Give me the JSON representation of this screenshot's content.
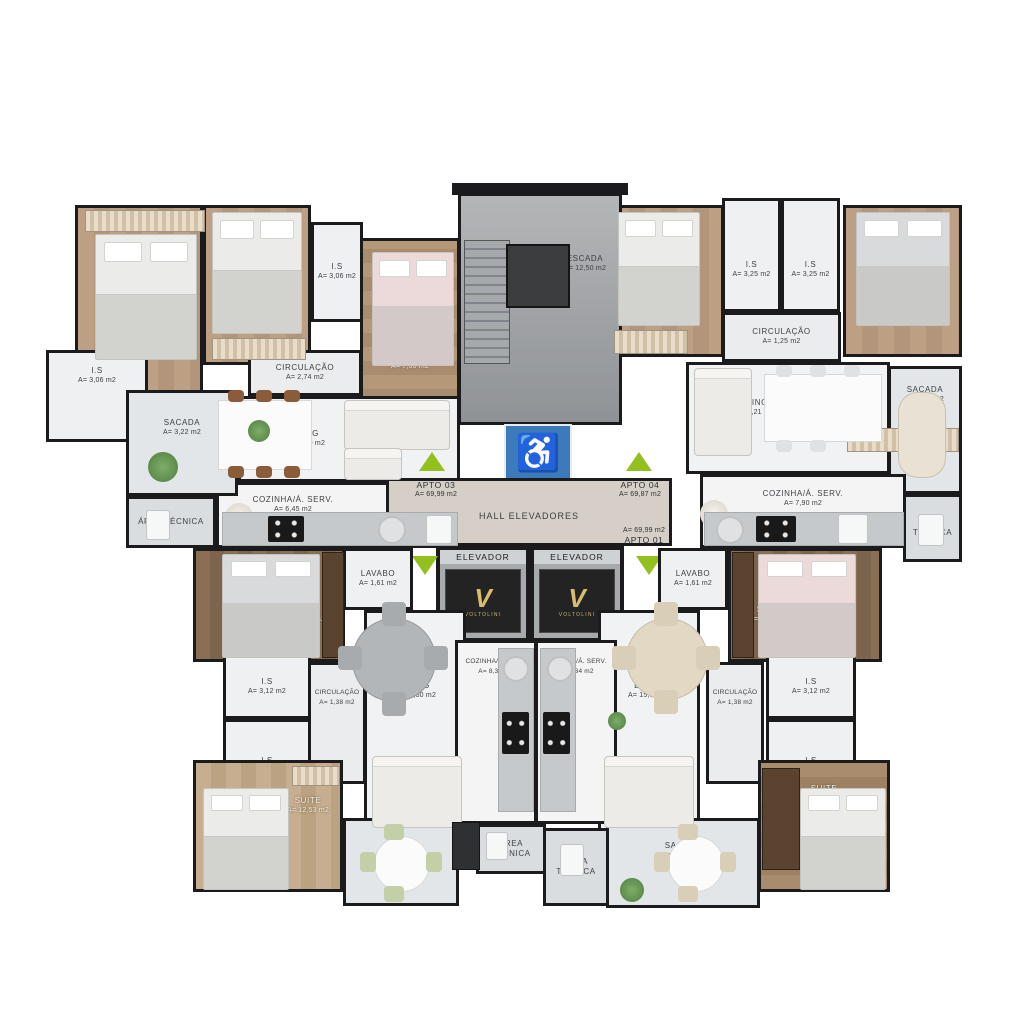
{
  "apartments": {
    "apto03": {
      "label": "APTO 03",
      "area": "A= 69,99 m2"
    },
    "apto04": {
      "label": "APTO 04",
      "area": "A= 69,87 m2"
    },
    "apto02": {
      "label": "APTO 02",
      "area": "A= 69,98 m2"
    },
    "apto01": {
      "label": "APTO 01",
      "area": "A= 69,99 m2"
    }
  },
  "core": {
    "escada": {
      "label": "ESCADA",
      "area": "A= 12,50 m2"
    },
    "hall": {
      "label": "HALL ELEVADORES"
    },
    "elevador1": {
      "label": "ELEVADOR",
      "brand": "VOLTOLINI"
    },
    "elevador2": {
      "label": "ELEVADOR",
      "brand": "VOLTOLINI"
    },
    "accessibility_symbol": "♿"
  },
  "rooms": {
    "a3_suite": {
      "label": "SUITE",
      "area": "A= 10,71 m2"
    },
    "a3_dorm1": {
      "label": "DORMITORIO",
      "area": "A= 7,60 m2"
    },
    "a3_dorm2": {
      "label": "DORMITORIO",
      "area": "A= 7,60 m2"
    },
    "a3_is1": {
      "label": "I.S",
      "area": "A= 3,06 m2"
    },
    "a3_is2": {
      "label": "I.S",
      "area": "A= 3,06 m2"
    },
    "a3_circ": {
      "label": "CIRCULAÇÃO",
      "area": "A= 2,74 m2"
    },
    "a3_living": {
      "label": "LIVING",
      "area": "A= 16,00 m2"
    },
    "a3_cozinha": {
      "label": "COZINHA/Á. SERV.",
      "area": "A= 6,45 m2"
    },
    "a3_sacada": {
      "label": "SACADA",
      "area": "A= 3,22 m2"
    },
    "a3_area_tecnica": {
      "label": "ÁREA TÉCNICA"
    },
    "a4_dorm": {
      "label": "DORMITORIO",
      "area": "A= 10,33 m2"
    },
    "a4_is1": {
      "label": "I.S",
      "area": "A= 3,25 m2"
    },
    "a4_is2": {
      "label": "I.S",
      "area": "A= 3,25 m2"
    },
    "a4_circ": {
      "label": "CIRCULAÇÃO",
      "area": "A= 1,25 m2"
    },
    "a4_suite": {
      "label": "SUITE",
      "area": "A= 11,34 m2"
    },
    "a4_living": {
      "label": "LIVING",
      "area": "A= 18,21 m2"
    },
    "a4_cozinha": {
      "label": "COZINHA/Á. SERV.",
      "area": "A= 7,90 m2"
    },
    "a4_sacada": {
      "label": "SACADA",
      "area": "A= 4,56 m2"
    },
    "a4_area_tecnica": {
      "label": "ÁREA TÉCNICA"
    },
    "a2_suite1": {
      "label": "SUITE",
      "area": "A= 10,95 m2"
    },
    "a2_lavabo": {
      "label": "LAVABO",
      "area": "A= 1,61 m2"
    },
    "a2_is1": {
      "label": "I.S",
      "area": "A= 3,12 m2"
    },
    "a2_is2": {
      "label": "I.S",
      "area": "A= 3,12 m2"
    },
    "a2_circ": {
      "label": "CIRCULAÇÃO",
      "area": "A= 1,38 m2"
    },
    "a2_living": {
      "label": "LIVING",
      "area": "A= 15,80 m2"
    },
    "a2_cozinha": {
      "label": "COZINHA/Á. SERV.",
      "area": "A= 8,34 m2"
    },
    "a2_suite2": {
      "label": "SUITE",
      "area": "A= 12,53 m2"
    },
    "a2_sacada": {
      "label": "SACADA",
      "area": "A= 4,88 m2"
    },
    "a2_area_tecnica": {
      "label": "ÁREA TÉCNICA"
    },
    "a1_lavabo": {
      "label": "LAVABO",
      "area": "A= 1,61 m2"
    },
    "a1_suite1": {
      "label": "SUITE",
      "area": "A= 10,95 m2"
    },
    "a1_circ": {
      "label": "CIRCULAÇÃO",
      "area": "A= 1,38 m2"
    },
    "a1_is1": {
      "label": "I.S",
      "area": "A= 3,12 m2"
    },
    "a1_is2": {
      "label": "I.S",
      "area": "A= 3,12 m2"
    },
    "a1_living": {
      "label": "LIVING",
      "area": "A= 15,80 m2"
    },
    "a1_cozinha": {
      "label": "COZINHA/Á. SERV.",
      "area": "A= 8,34 m2"
    },
    "a1_suite2": {
      "label": "SUITE",
      "area": "A= 11,66 m2"
    },
    "a1_sacada": {
      "label": "SACADA",
      "area": "A= 6,15 m2"
    },
    "a1_area_tecnica": {
      "label": "ÁREA TÉCNICA"
    }
  },
  "colors": {
    "wall": "#1b1b1d",
    "entry_arrow_green": "#93c01f",
    "accessibility_blue": "#3c7abc",
    "elevator_brand_gold": "#d9bc6e"
  }
}
